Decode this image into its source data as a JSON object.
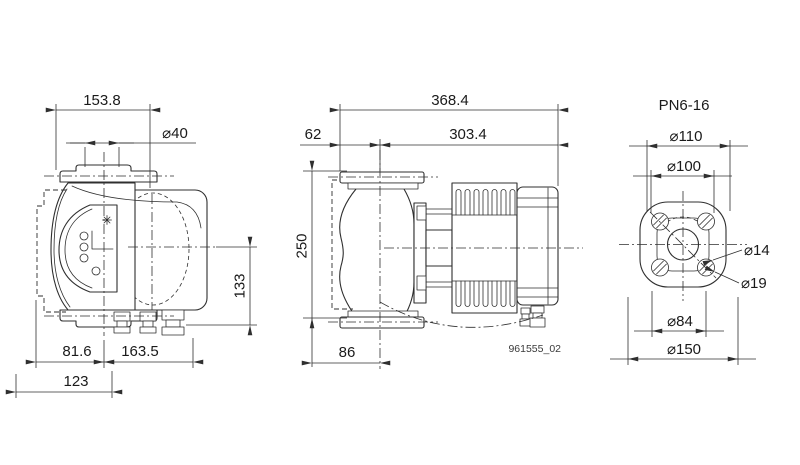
{
  "drawing": {
    "background": "#ffffff",
    "line_color": "#2f2f2f",
    "front_view": {
      "dims": {
        "overall_width": "153.8",
        "port_diameter": "⌀40",
        "height": "133",
        "bottom_left": "81.6",
        "bottom_right": "163.5",
        "bottom_overall": "123"
      }
    },
    "side_view": {
      "dims": {
        "overall_length": "368.4",
        "flange_offset": "62",
        "body_length": "303.4",
        "port_to_port": "250",
        "flange_width": "86"
      },
      "drawing_ref": "961555_02"
    },
    "flange_view": {
      "pressure_rating": "PN6-16",
      "dims": {
        "pilot_diameter": "⌀110",
        "bolt_circle": "⌀100",
        "bolt_hole": "⌀14",
        "counterbore": "⌀19",
        "raised_face": "⌀84",
        "outer_diameter": "⌀150"
      }
    }
  }
}
